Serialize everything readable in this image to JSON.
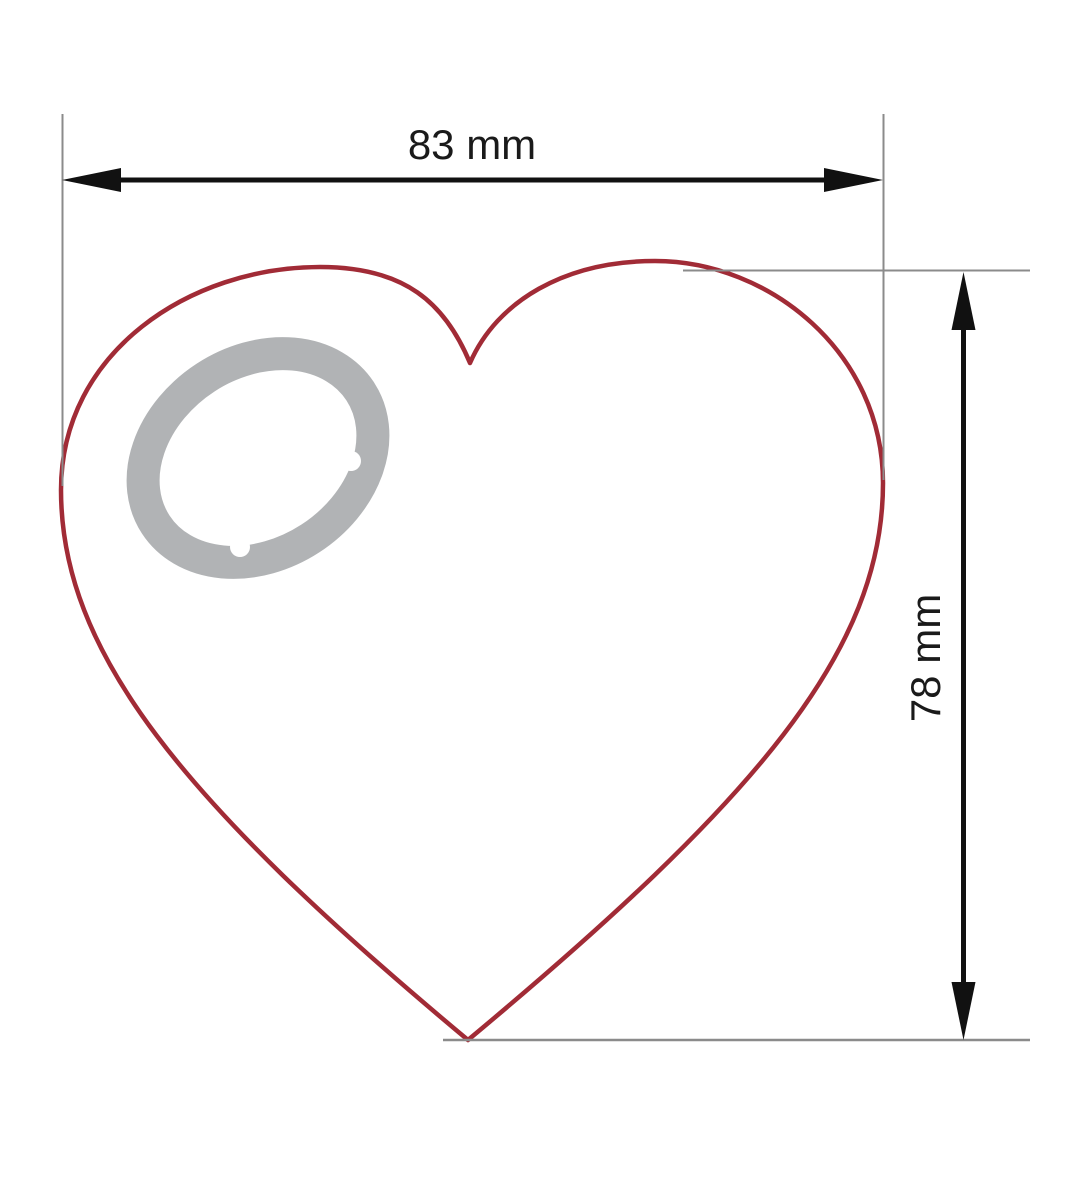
{
  "drawing": {
    "kind": "technical dimension drawing",
    "subject": "heart-shaped part with split keyring hole",
    "width_dimension_label": "83 mm",
    "height_dimension_label": "78 mm"
  },
  "colors": {
    "background": "#ffffff",
    "heart_outline": "#a12b36",
    "ring_gray": "#b1b3b5",
    "dimension_black": "#111111",
    "extension_gray": "#8b8b8b",
    "label_text": "#1a1a1a"
  }
}
